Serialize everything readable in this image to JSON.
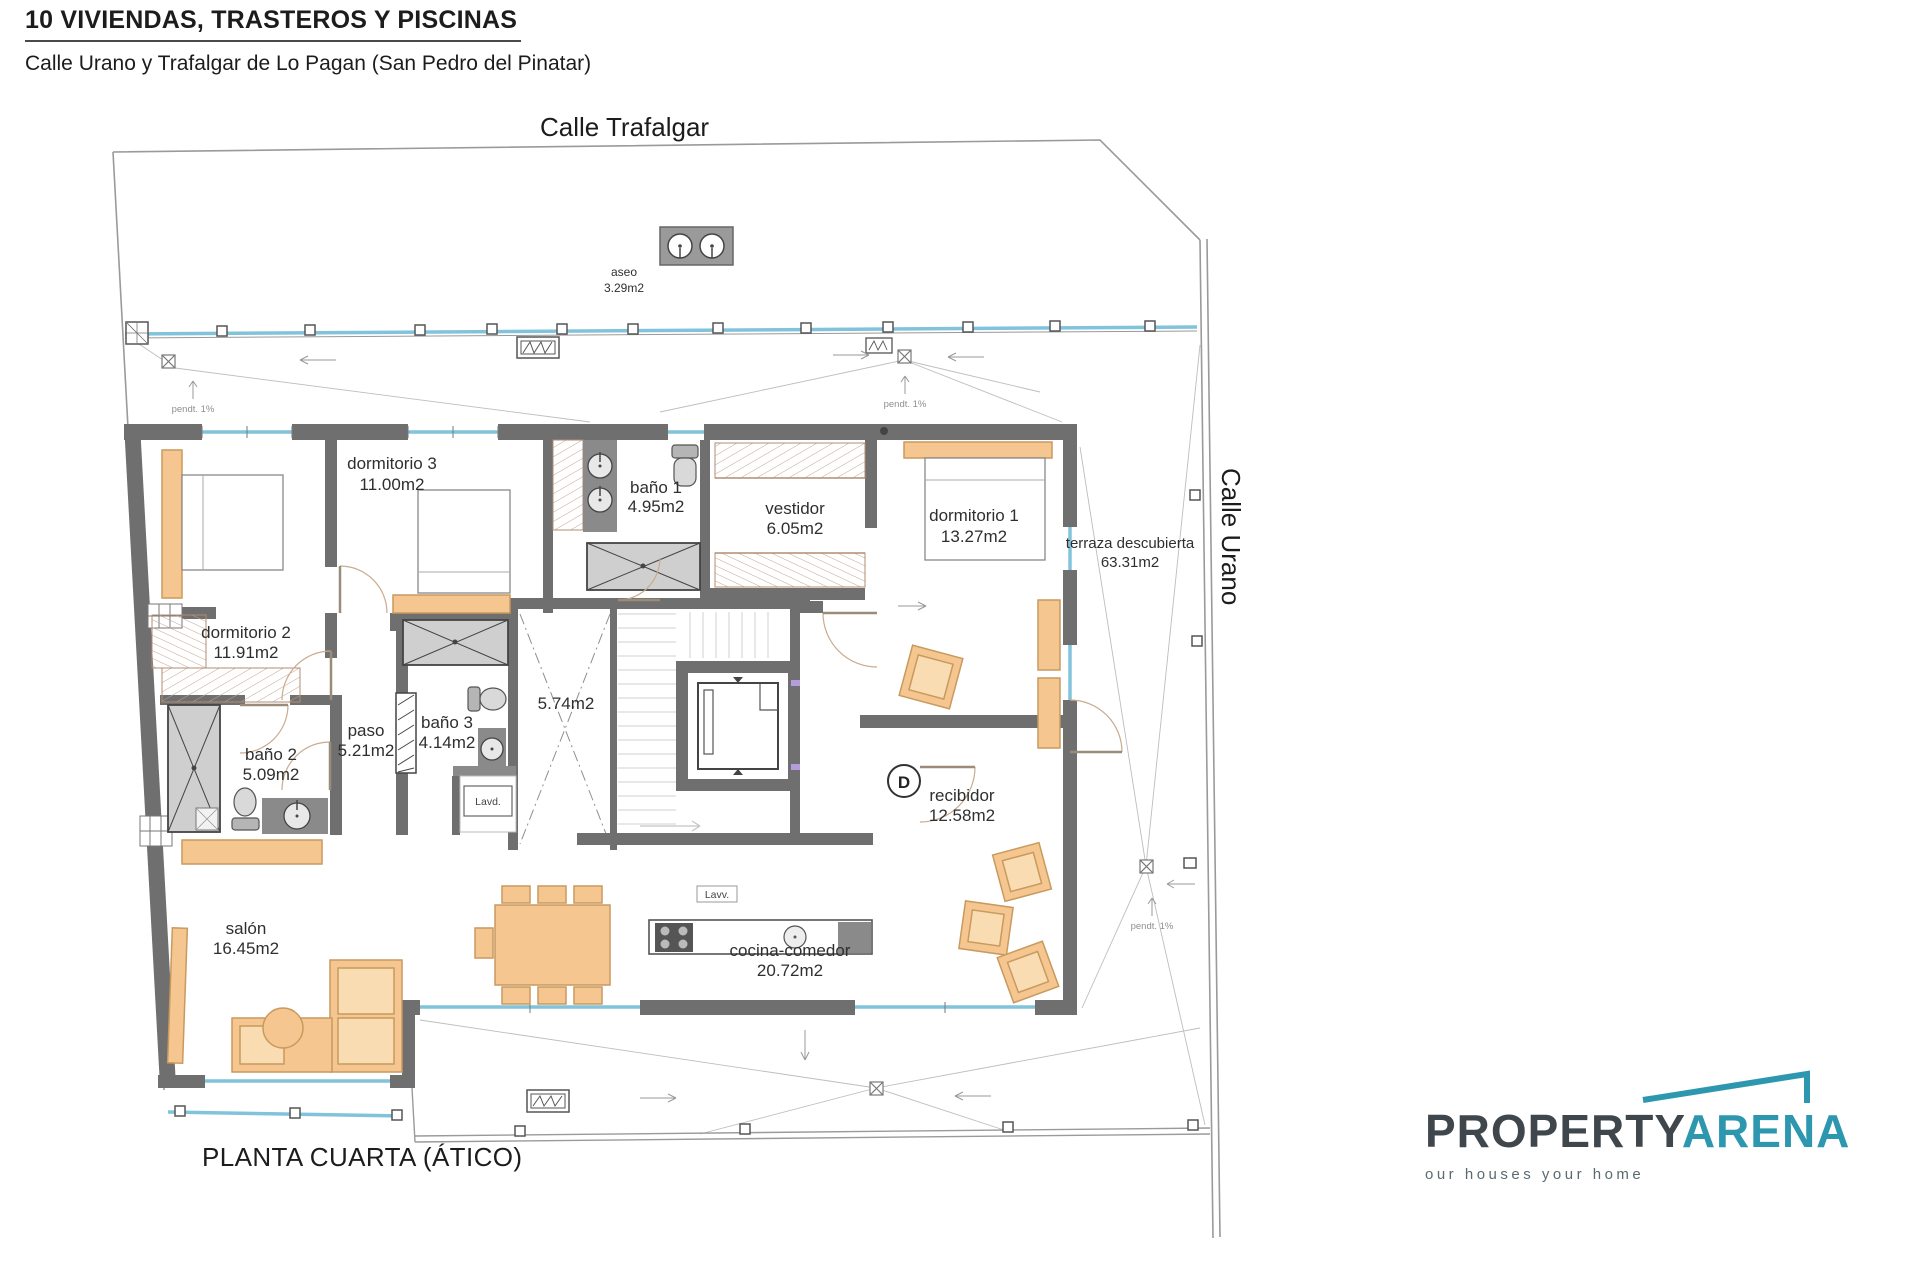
{
  "header": {
    "title": "10 VIVIENDAS, TRASTEROS Y PISCINAS",
    "subtitle": "Calle Urano y Trafalgar de Lo Pagan (San Pedro del Pinatar)"
  },
  "streets": {
    "top": "Calle Trafalgar",
    "right": "Calle Urano"
  },
  "floor_label": "PLANTA CUARTA (ÁTICO)",
  "logo": {
    "part1": "PROPERTY",
    "part2": "ARENA",
    "tagline": "our houses your home"
  },
  "rooms": [
    {
      "name": "aseo",
      "area": "3.29m2"
    },
    {
      "name": "dormitorio 3",
      "area": "11.00m2"
    },
    {
      "name": "baño 1",
      "area": "4.95m2"
    },
    {
      "name": "vestidor",
      "area": "6.05m2"
    },
    {
      "name": "dormitorio 1",
      "area": "13.27m2"
    },
    {
      "name": "terraza descubierta",
      "area": "63.31m2"
    },
    {
      "name": "dormitorio 2",
      "area": "11.91m2"
    },
    {
      "name": "paso",
      "area": "5.21m2"
    },
    {
      "name": "baño 3",
      "area": "4.14m2"
    },
    {
      "name": "",
      "area": "5.74m2"
    },
    {
      "name": "baño 2",
      "area": "5.09m2"
    },
    {
      "name": "recibidor",
      "area": "12.58m2"
    },
    {
      "name": "salón",
      "area": "16.45m2"
    },
    {
      "name": "cocina-comedor",
      "area": "20.72m2"
    }
  ],
  "annotations": {
    "slope": "pendt. 1%",
    "laundry": "Lavd.",
    "dishwasher": "Lavv.",
    "door_marker": "D"
  },
  "colors": {
    "wall": "#6f6f6f",
    "accent_orange": "#f6c690",
    "glass_blue": "#82c3dc",
    "brand_teal": "#2e97b0"
  }
}
